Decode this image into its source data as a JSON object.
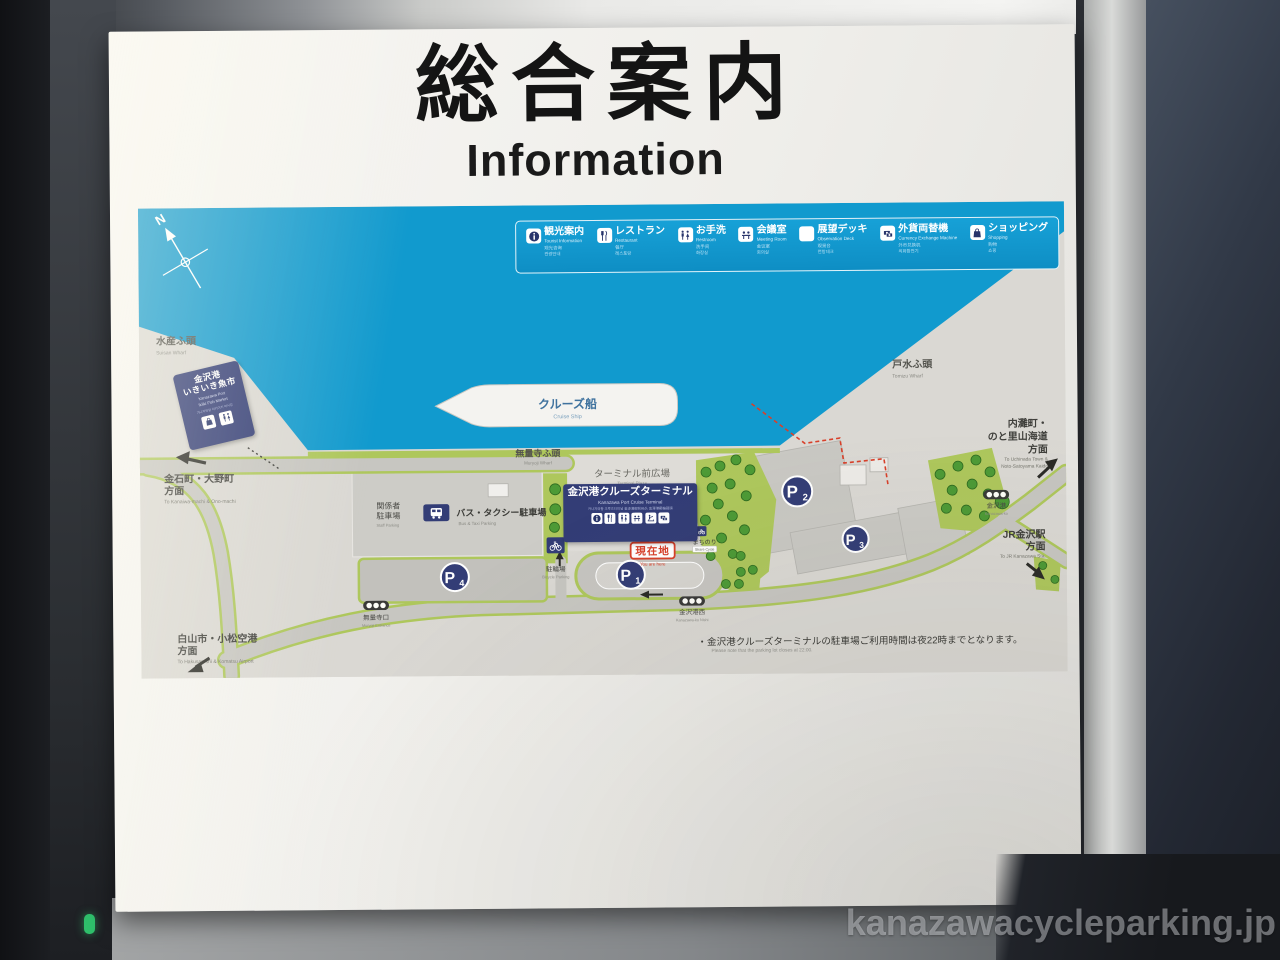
{
  "title": {
    "ja": "総合案内",
    "en": "Information"
  },
  "legend": {
    "items": [
      {
        "ja": "観光案内",
        "en": "Tourist Information",
        "zh": "观光咨询",
        "ko": "관광안내"
      },
      {
        "ja": "レストラン",
        "en": "Restaurant",
        "zh": "餐厅",
        "ko": "레스토랑"
      },
      {
        "ja": "お手洗",
        "en": "Restroom",
        "zh": "洗手间",
        "ko": "화장실"
      },
      {
        "ja": "会議室",
        "en": "Meeting Room",
        "zh": "会议室",
        "ko": "회의실"
      },
      {
        "ja": "展望デッキ",
        "en": "Observation Deck",
        "zh": "观景台",
        "ko": "전망데크"
      },
      {
        "ja": "外貨両替機",
        "en": "Currency Exchange Machine",
        "zh": "外币兑换机",
        "ko": "외화환전기"
      },
      {
        "ja": "ショッピング",
        "en": "Shopping",
        "zh": "购物",
        "ko": "쇼핑"
      }
    ]
  },
  "map": {
    "compass": "N",
    "cruise_ship": {
      "ja": "クルーズ船",
      "en": "Cruise Ship"
    },
    "wharves": {
      "suisan": {
        "ja": "水産ふ頭",
        "en": "Suisan Wharf"
      },
      "muryoji": {
        "ja": "無量寺ふ頭",
        "en": "Muryoji Wharf"
      },
      "tomizu": {
        "ja": "戸水ふ頭",
        "en": "Tomizu Wharf"
      }
    },
    "fish_market": {
      "ja1": "金沢港",
      "ja2": "いきいき魚市",
      "en1": "Kanazawa Port",
      "en2": "Ikiiki Fish Market",
      "sub": "가나자와항 이키이키 어시장"
    },
    "terminal": {
      "ja": "金沢港クルーズターミナル",
      "en": "Kanazawa Port Cruise Terminal",
      "sub": "카나자와항 크루즈터미널  金泽港邮轮码头  金澤港郵輪碼頭"
    },
    "terminal_plaza": {
      "ja": "ターミナル前広場",
      "en": "Terminal Plaza"
    },
    "parking": {
      "staff": {
        "ja1": "関係者",
        "ja2": "駐車場",
        "en": "Staff Parking"
      },
      "bus_taxi": {
        "ja": "バス・タクシー駐車場",
        "en": "Bus & Taxi Parking"
      },
      "bicycle": {
        "ja": "駐輪場",
        "en": "Bicycle Parking"
      }
    },
    "p_markers": [
      {
        "p": "P",
        "n": "1"
      },
      {
        "p": "P",
        "n": "2"
      },
      {
        "p": "P",
        "n": "3"
      },
      {
        "p": "P",
        "n": "4"
      }
    ],
    "machinori": {
      "ja": "まちのり",
      "en": "Share Cycle"
    },
    "you_are_here": {
      "ja": "現在地",
      "en": "You are here"
    },
    "signals": [
      {
        "ja": "無量寺口",
        "en": "Muryoji Entrance"
      },
      {
        "ja": "金沢港西",
        "en": "Kanazawa-ko Nishi"
      },
      {
        "ja": "金沢港",
        "en": "Kanazawa-ko"
      }
    ],
    "directions": [
      {
        "ja1": "金石町・大野町",
        "ja2": "方面",
        "en1": "To Kanaiwa-machi & Ono-machi",
        "en2": ""
      },
      {
        "ja1": "白山市・小松空港",
        "ja2": "方面",
        "en1": "To Hakusan-shi & Komatsu Airport",
        "en2": ""
      },
      {
        "ja1": "内灘町・",
        "ja2": "のと里山海道",
        "ja3": "方面",
        "en1": "To Uchinada Town &",
        "en2": "Noto-Satoyama Kaido"
      },
      {
        "ja1": "JR金沢駅",
        "ja2": "方面",
        "en1": "To JR Kanazawa Sta.",
        "en2": ""
      }
    ],
    "note": {
      "ja": "・金沢港クルーズターミナルの駐車場ご利用時間は夜22時までとなります。",
      "en": "Please note that the parking lot closes at 22:00."
    }
  },
  "watermark": "kanazawacycleparking.jp",
  "colors": {
    "sea": "#119ace",
    "navy": "#333d76",
    "land": "#dad8d3",
    "road": "#c7c6c1",
    "green": "#aec75c",
    "tree": "#4d9a36",
    "red": "#d8402a"
  }
}
